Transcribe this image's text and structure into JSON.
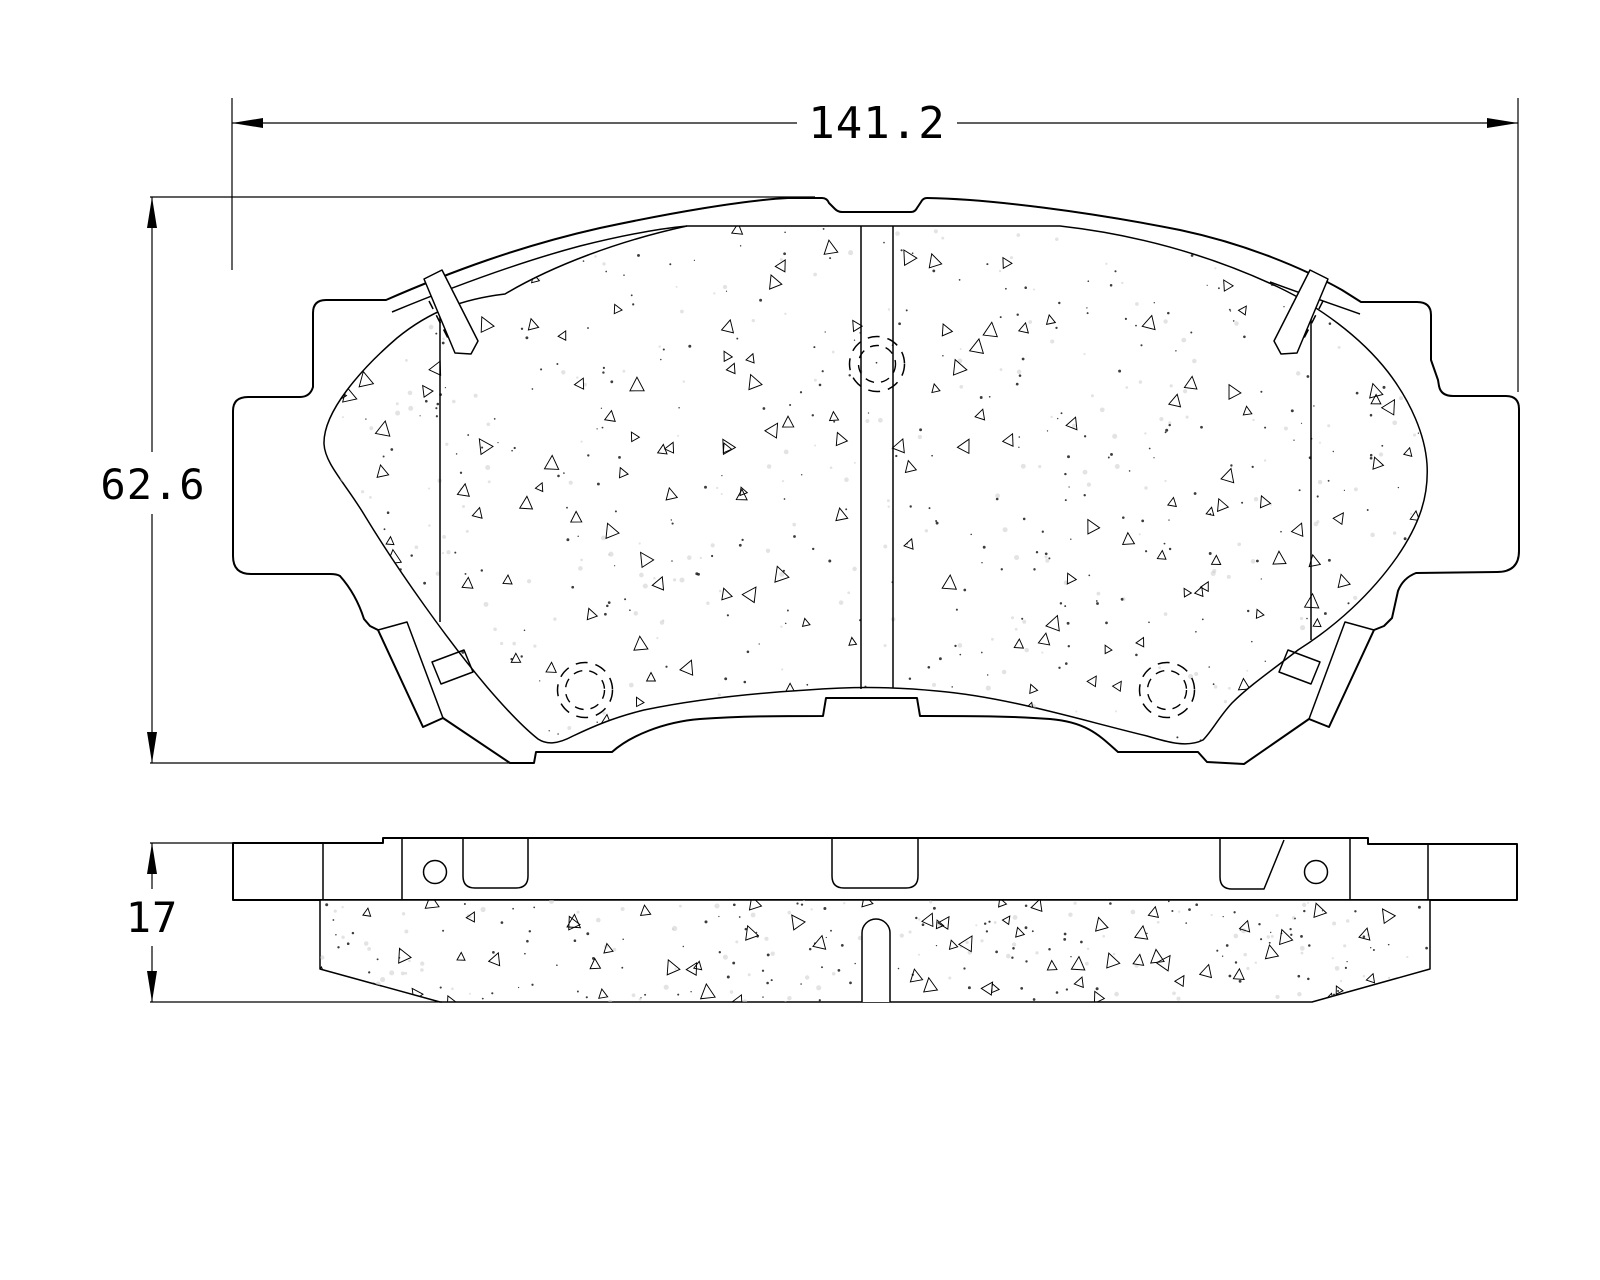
{
  "page": {
    "background": "#ffffff",
    "line_color": "#000000",
    "text_color": "#000000"
  },
  "drawing": {
    "type": "technical-drawing",
    "dimensions": {
      "width": {
        "value": "141.2"
      },
      "height": {
        "value": "62.6"
      },
      "thickness": {
        "value": "17"
      }
    }
  },
  "texture": {
    "front": {
      "seed": 1234,
      "triangles": 160,
      "dots": 380,
      "faint": 300,
      "bbox": [
        322,
        218,
        1432,
        748
      ]
    },
    "side": {
      "seed": 5678,
      "triangles": 62,
      "dots": 150,
      "faint": 120,
      "bbox": [
        318,
        898,
        1434,
        1004
      ]
    }
  }
}
